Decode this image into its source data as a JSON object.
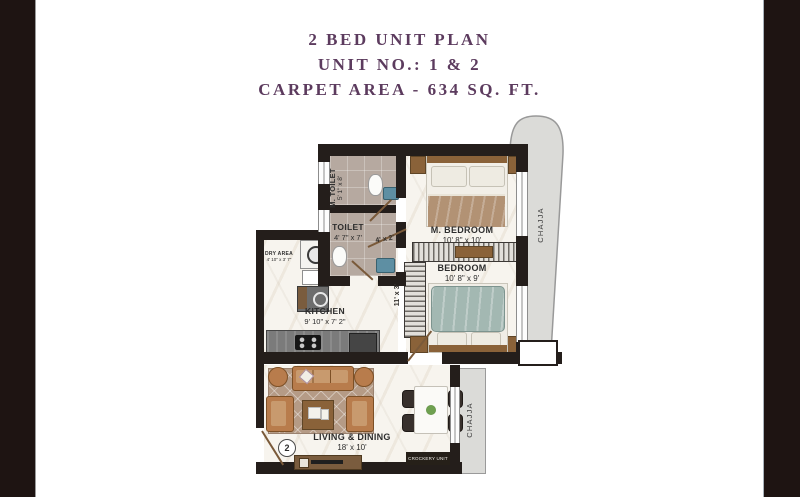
{
  "window": {
    "side_bar_color": "#1e1412",
    "wall_color": "#241e1b",
    "title_color": "#5c3b5e"
  },
  "title": {
    "line1": "2 BED UNIT PLAN",
    "line2": "UNIT NO.: 1 & 2",
    "line3": "CARPET AREA - 634 SQ. FT."
  },
  "rooms": {
    "m_toilet": {
      "name": "M. TOILET",
      "dims": "5' 1\" x 8'"
    },
    "toilet": {
      "name": "TOILET",
      "dims": "4' 7\" x 7'"
    },
    "dry_area": {
      "name": "DRY AREA",
      "dims": "4' 10\" x 3' 7\""
    },
    "kitchen": {
      "name": "KITCHEN",
      "dims": "9' 10\" x 7' 2\""
    },
    "m_bedroom": {
      "name": "M. BEDROOM",
      "dims": "10' 8\" x 10'"
    },
    "bedroom": {
      "name": "BEDROOM",
      "dims": "10' 8\" x 9'"
    },
    "living_dining": {
      "name": "LIVING & DINING",
      "dims": "18' x 10'"
    },
    "passage": {
      "dims": "11' x 3'"
    },
    "foyer": {
      "dims": "4' x 2'"
    }
  },
  "annotations": {
    "chajja_top": "CHAJJA",
    "chajja_bottom": "CHAJJA",
    "crockery_unit": "CROCKERY UNIT",
    "unit_marker": "2"
  }
}
